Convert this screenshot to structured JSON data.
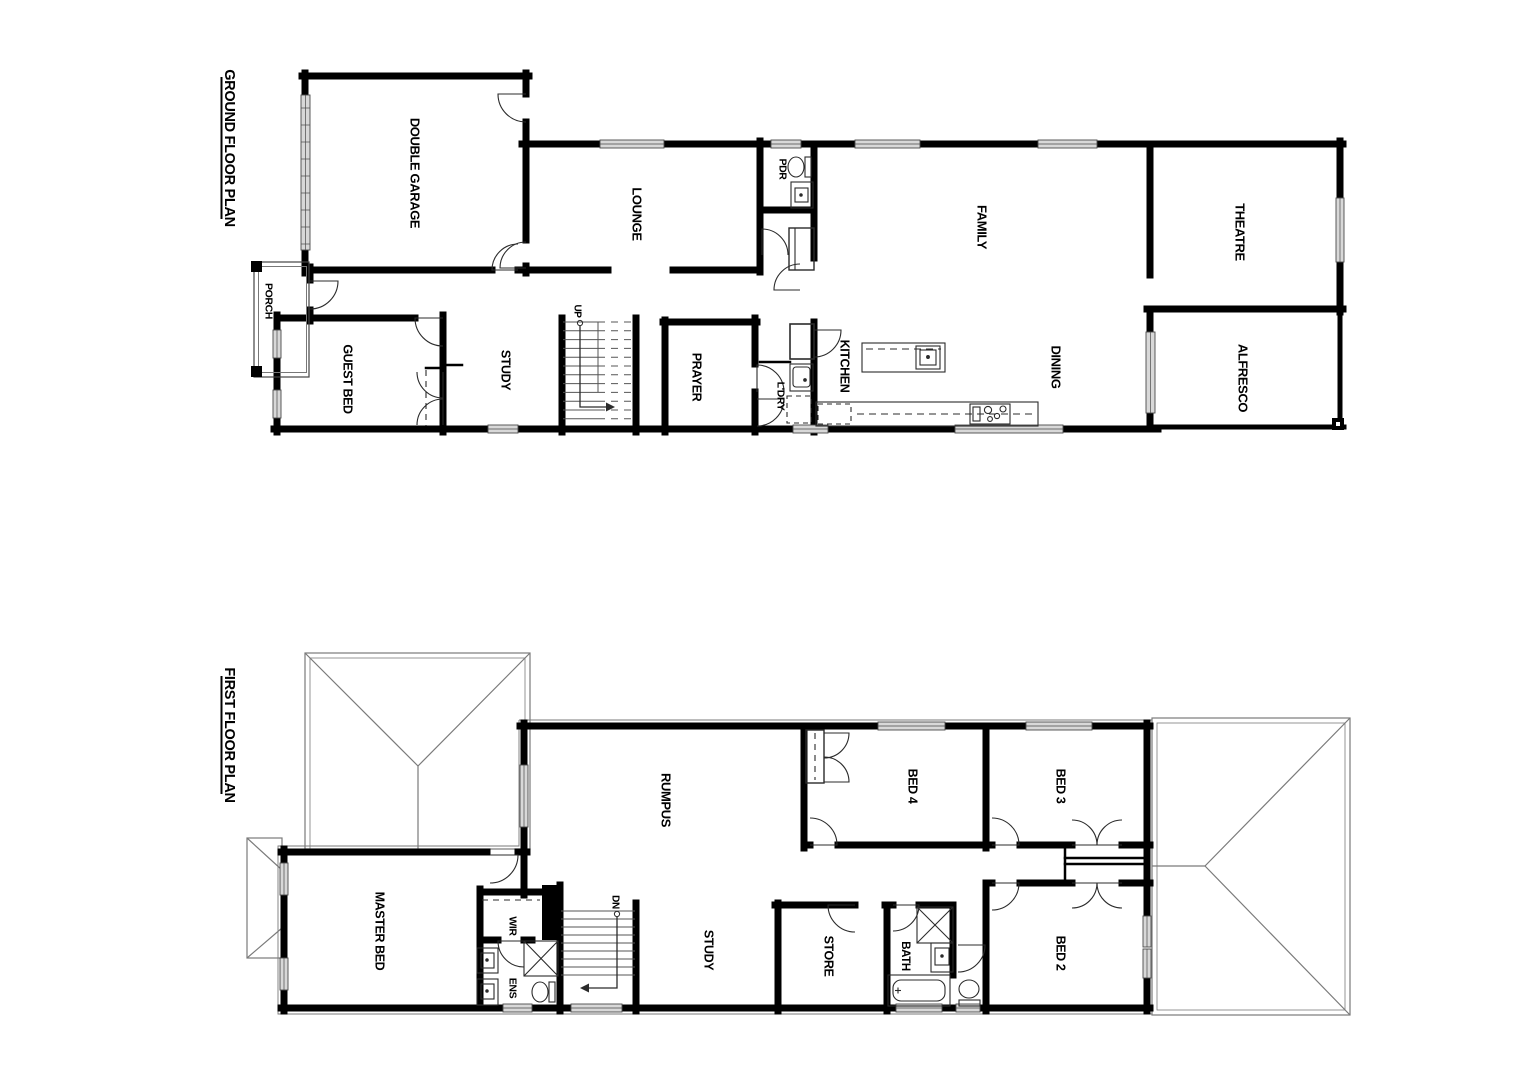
{
  "drawing": {
    "type": "residential floor plan",
    "colors": {
      "wall": "#000000",
      "detail": "#2b2b2b",
      "thin": "#555555",
      "window_fill": "#d8d8d8",
      "roof_line": "#7a7a7a"
    }
  },
  "ground_floor": {
    "title": "GROUND FLOOR PLAN",
    "stair_direction": "UP",
    "rooms": {
      "double_garage": "DOUBLE GARAGE",
      "porch": "PORCH",
      "guest_bed": "GUEST BED",
      "study": "STUDY",
      "prayer": "PRAYER",
      "lounge": "LOUNGE",
      "pdr": "PDR",
      "laundry": "L'DRY",
      "kitchen": "KITCHEN",
      "family": "FAMILY",
      "dining": "DINING",
      "theatre": "THEATRE",
      "alfresco": "ALFRESCO"
    }
  },
  "first_floor": {
    "title": "FIRST FLOOR PLAN",
    "stair_direction": "DN",
    "rooms": {
      "master_bed": "MASTER BED",
      "wir": "WIR",
      "ens": "ENS",
      "rumpus": "RUMPUS",
      "study": "STUDY",
      "store": "STORE",
      "bath": "BATH",
      "bed_2": "BED 2",
      "bed_3": "BED 3",
      "bed_4": "BED 4"
    }
  }
}
